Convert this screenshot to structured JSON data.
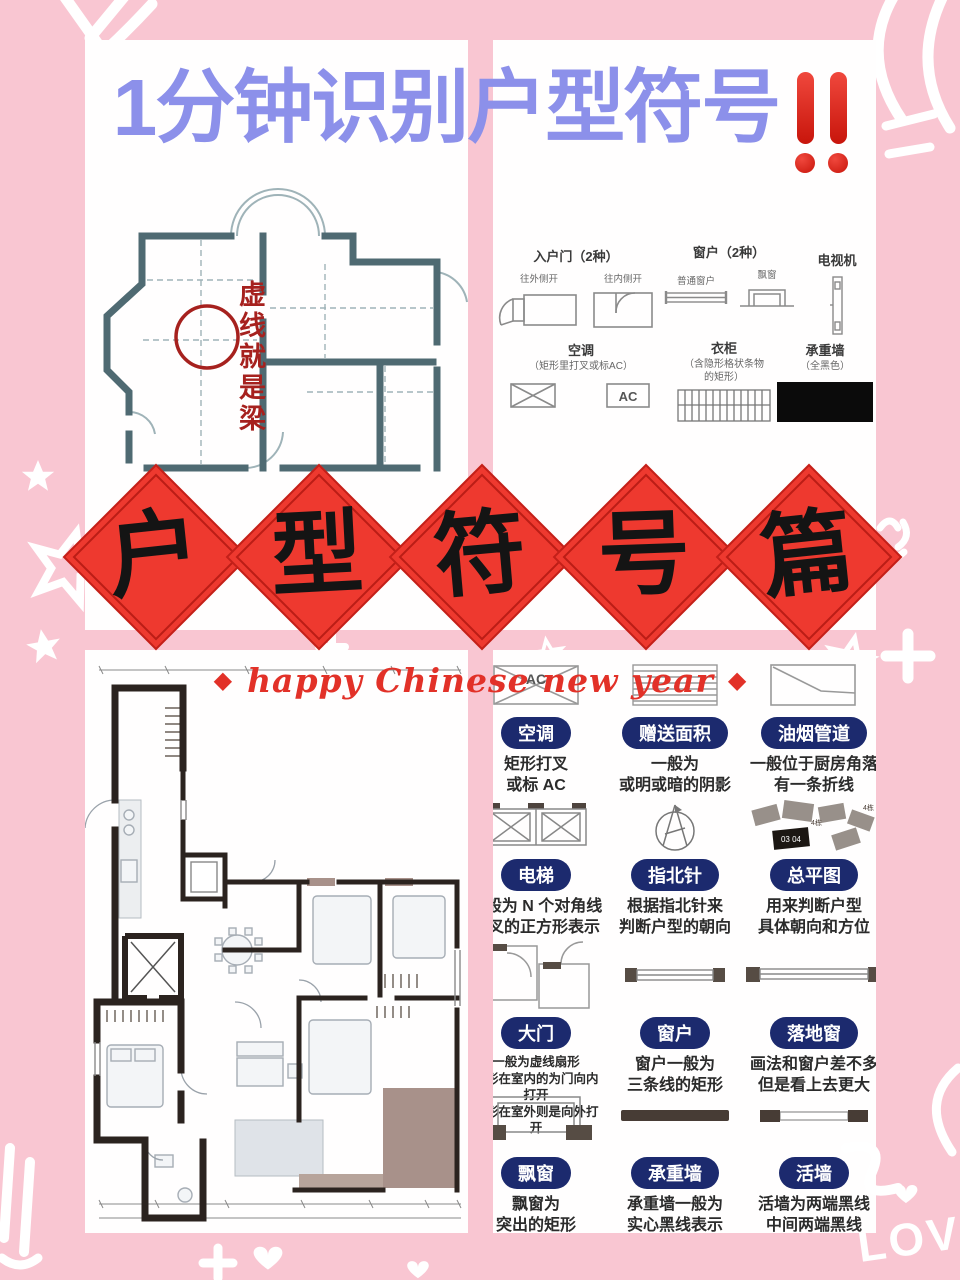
{
  "colors": {
    "background_pink": "#f9c6d2",
    "panel_white": "#fffefe",
    "title_purple": "#8c90ea",
    "diamond_red": "#ee392f",
    "pill_navy": "#1c2a6e",
    "accent_red": "#e23128",
    "beam_red": "#a6211e",
    "teal_wall": "#4f6a72",
    "dark_wall": "#2b231f"
  },
  "title": {
    "text": "1分钟识别户型符号",
    "icon": "double-exclamation-icon"
  },
  "beam_plan": {
    "annotation": "虚线就是梁"
  },
  "legend": {
    "entry_door": {
      "title": "入户门（2种）",
      "outward_label": "往外侧开",
      "inward_label": "往内侧开"
    },
    "window": {
      "title": "窗户（2种）",
      "normal_label": "普通窗户",
      "bay_label": "飘窗"
    },
    "tv": {
      "title": "电视机"
    },
    "ac": {
      "title": "空调",
      "note": "（矩形里打叉或标AC）",
      "ac_label": "AC"
    },
    "wardrobe": {
      "title": "衣柜",
      "note": "（含隐形格状条物\n的矩形）"
    },
    "bearing_wall": {
      "title": "承重墙",
      "note": "（全黑色）"
    }
  },
  "banner": {
    "chars": [
      "户",
      "型",
      "符",
      "号",
      "篇"
    ]
  },
  "greeting": {
    "bullet": "◆",
    "text": "happy Chinese new year"
  },
  "grid": {
    "cells": [
      {
        "label": "空调",
        "desc": "矩形打叉\n或标 AC",
        "symbol": "ac-crossed-rect",
        "ac_label": "AC"
      },
      {
        "label": "赠送面积",
        "desc": "一般为\n或明或暗的阴影",
        "symbol": "shaded-rect"
      },
      {
        "label": "油烟管道",
        "desc": "一般位于厨房角落\n有一条折线",
        "symbol": "duct-fold-line"
      },
      {
        "label": "电梯",
        "desc": "一般为 N 个对角线\n交叉的正方形表示",
        "symbol": "elevator-crossed-squares"
      },
      {
        "label": "指北针",
        "desc": "根据指北针来\n判断户型的朝向",
        "symbol": "compass-arrow"
      },
      {
        "label": "总平图",
        "desc": "用来判断户型\n具体朝向和方位",
        "symbol": "site-plan-cluster",
        "tags": [
          "03 04",
          "4栋",
          "4栋"
        ]
      },
      {
        "label": "大门",
        "desc": "一般为虚线扇形\n扇形在室内的为门向内打开\n扇形在室外则是向外打开",
        "symbol": "door-arc-boxes"
      },
      {
        "label": "窗户",
        "desc": "窗户一般为\n三条线的矩形",
        "symbol": "triple-line-window"
      },
      {
        "label": "落地窗",
        "desc": "画法和窗户差不多\n但是看上去更大",
        "symbol": "wide-triple-line-window"
      },
      {
        "label": "飘窗",
        "desc": "飘窗为\n突出的矩形",
        "symbol": "bay-window-protrusion"
      },
      {
        "label": "承重墙",
        "desc": "承重墙一般为\n实心黑线表示\n不可拆除",
        "symbol": "solid-black-bar"
      },
      {
        "label": "活墙",
        "desc": "活墙为两端黑线\n中间两端黑线",
        "symbol": "black-end-bar"
      }
    ]
  },
  "decor": {
    "love_text": "LOVE"
  }
}
